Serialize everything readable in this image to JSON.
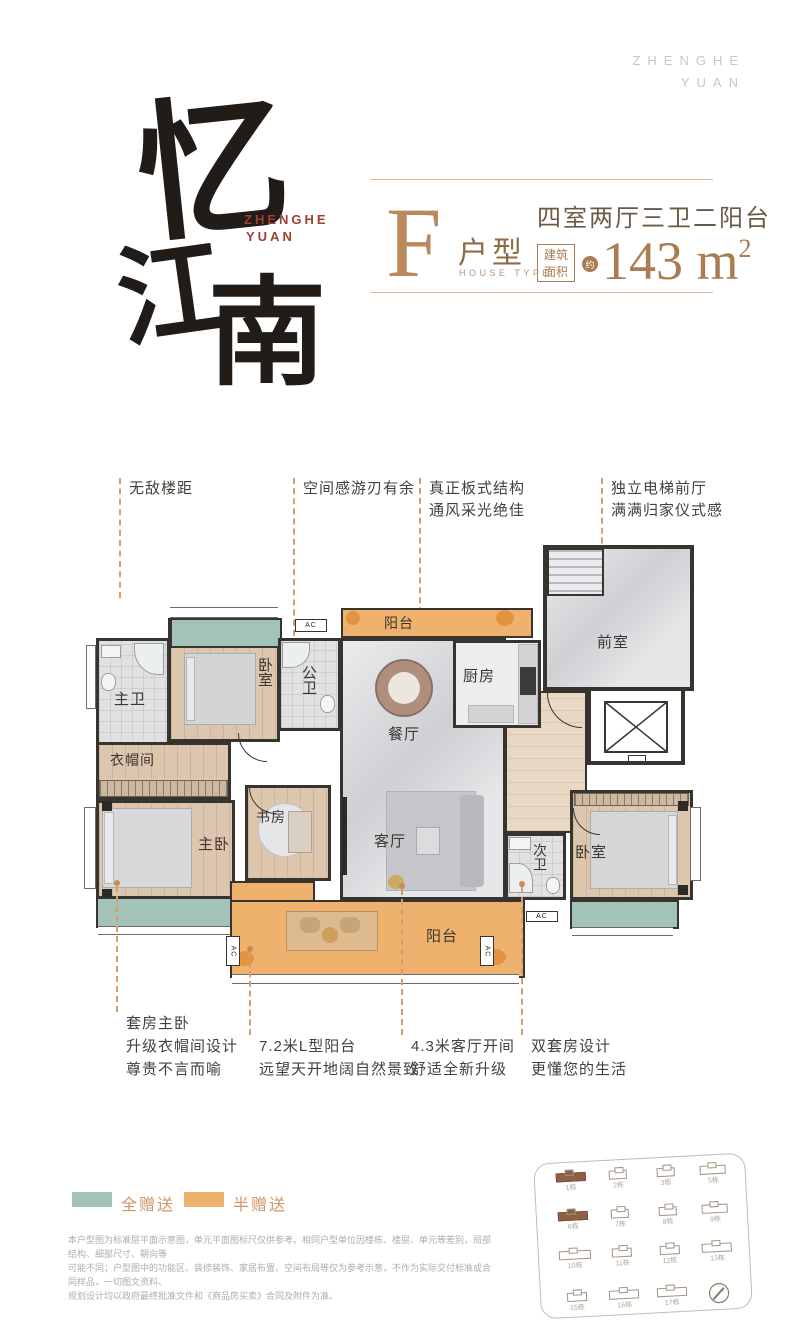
{
  "colors": {
    "accent_brown": "#a97c52",
    "letter_brown": "#b9885c",
    "teal": "#a3c3b9",
    "orange": "#eeb26e",
    "dashed_line": "#d3a06b",
    "logo_red": "#9e4033",
    "legend_label": "#d09468",
    "wall": "#37332f"
  },
  "watermark": {
    "line1": "ZHENGHE",
    "line2": "YUAN"
  },
  "logo": {
    "char1": "忆",
    "char2": "江",
    "char3": "南",
    "sub1": "ZHENGHE",
    "sub2": "YUAN"
  },
  "title": {
    "letter": "F",
    "type_label": "户型",
    "type_sub": "HOUSE TYPE",
    "layout": "四室两厅三卫二阳台",
    "badge_line1": "建筑",
    "badge_line2": "面积",
    "approx": "约",
    "area_value": "143 m",
    "area_sup": "2"
  },
  "callouts_top": [
    {
      "line1": "无敌楼距",
      "line2": ""
    },
    {
      "line1": "空间感游刃有余",
      "line2": ""
    },
    {
      "line1": "真正板式结构",
      "line2": "通风采光绝佳"
    },
    {
      "line1": "独立电梯前厅",
      "line2": "满满归家仪式感"
    }
  ],
  "callouts_bottom": [
    {
      "line1": "套房主卧",
      "line2": "升级衣帽间设计",
      "line3": "尊贵不言而喻"
    },
    {
      "line1": "7.2米L型阳台",
      "line2": "远望天开地阔自然景致",
      "line3": ""
    },
    {
      "line1": "4.3米客厅开间",
      "line2": "舒适全新升级",
      "line3": ""
    },
    {
      "line1": "双套房设计",
      "line2": "更懂您的生活",
      "line3": ""
    }
  ],
  "plan": {
    "ac_label": "AC",
    "rooms": {
      "master_bath": "主卫",
      "bedroom_top": "卧室",
      "public_bath": "公卫",
      "balcony_top": "阳台",
      "kitchen": "厨房",
      "front_room": "前室",
      "dining": "餐厅",
      "cloakroom": "衣帽间",
      "master_bedroom": "主卧",
      "study": "书房",
      "living": "客厅",
      "second_bath": "次卫",
      "bedroom_right": "卧室",
      "balcony_bottom": "阳台"
    }
  },
  "legend": {
    "items": [
      {
        "label": "全赠送",
        "color": "#a3c3b9"
      },
      {
        "label": "半赠送",
        "color": "#eeb26e"
      }
    ]
  },
  "disclaimer": {
    "line1": "本户型图为标准层平面示意图，单元平面图标尺仅供参考。相同户型单位因楼栋、楼层、单元等差别，局部结构、细部尺寸、朝向等",
    "line2": "可能不同；户型图中的功能区、装修装饰、家居布置、空间布局等仅为参考示意，不作为实际交付标准或合同样品，一切图文资料、",
    "line3": "规划设计均以政府最终批准文件和《商品房买卖》合同及附件为准。"
  },
  "siteplan": {
    "buildings": [
      {
        "label": "1栋",
        "highlight": true
      },
      {
        "label": "2栋",
        "highlight": false
      },
      {
        "label": "3栋",
        "highlight": false
      },
      {
        "label": "5栋",
        "highlight": false
      },
      {
        "label": "6栋",
        "highlight": true
      },
      {
        "label": "7栋",
        "highlight": false
      },
      {
        "label": "8栋",
        "highlight": false
      },
      {
        "label": "9栋",
        "highlight": false
      },
      {
        "label": "10栋",
        "highlight": false
      },
      {
        "label": "11栋",
        "highlight": false
      },
      {
        "label": "12栋",
        "highlight": false
      },
      {
        "label": "13栋",
        "highlight": false
      },
      {
        "label": "15栋",
        "highlight": false
      },
      {
        "label": "16栋",
        "highlight": false
      },
      {
        "label": "17栋",
        "highlight": false
      }
    ]
  }
}
